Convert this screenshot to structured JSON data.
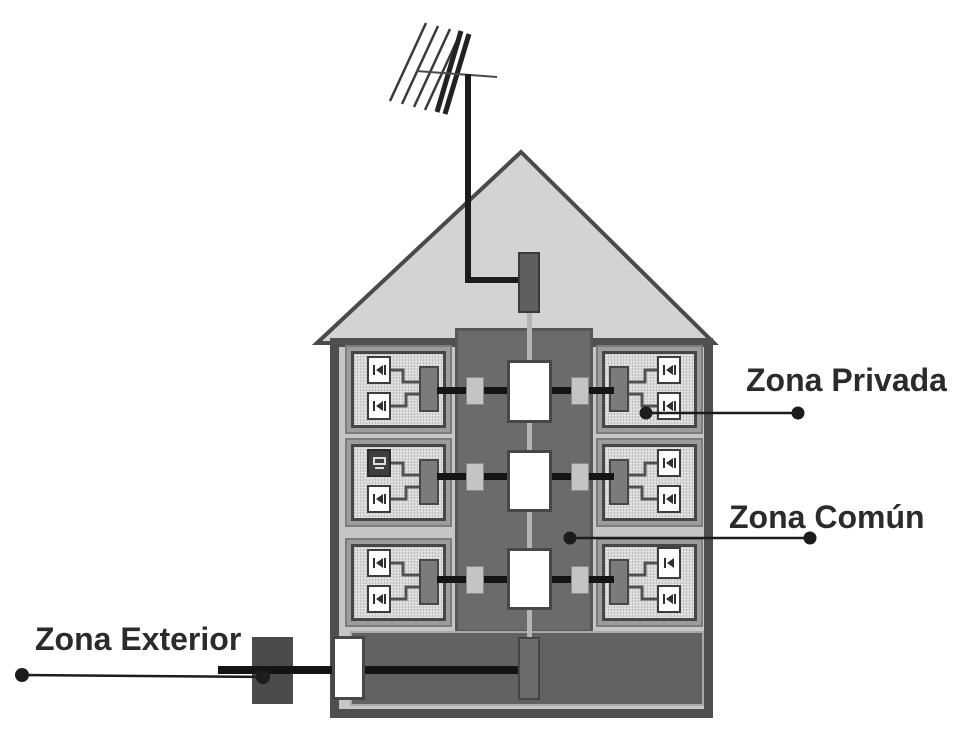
{
  "diagram": {
    "type": "building-common-telecom-infrastructure",
    "zones": [
      {
        "id": "zona-privada",
        "label": "Zona Privada"
      },
      {
        "id": "zona-comun",
        "label": "Zona Común"
      },
      {
        "id": "zona-exterior",
        "label": "Zona Exterior"
      }
    ],
    "building": {
      "floors": 3,
      "apartments_per_floor": 2,
      "sockets_per_apartment": 2
    }
  },
  "icons": {
    "antenna": "antenna-icon",
    "socket": "telecom-socket-icon",
    "tv": "tv-set-icon"
  },
  "colors": {
    "background": "#ffffff",
    "roof_fill": "#d3d3d3",
    "wall": "#4f4f4f",
    "interior": "#c6c6c6",
    "shaft": "#6b6b6b",
    "apartment_fill": "#d7d7d7",
    "ground_band": "#626262",
    "cable": "#141414",
    "callout": "#1c1c1c",
    "text": "#2b2b2b"
  }
}
